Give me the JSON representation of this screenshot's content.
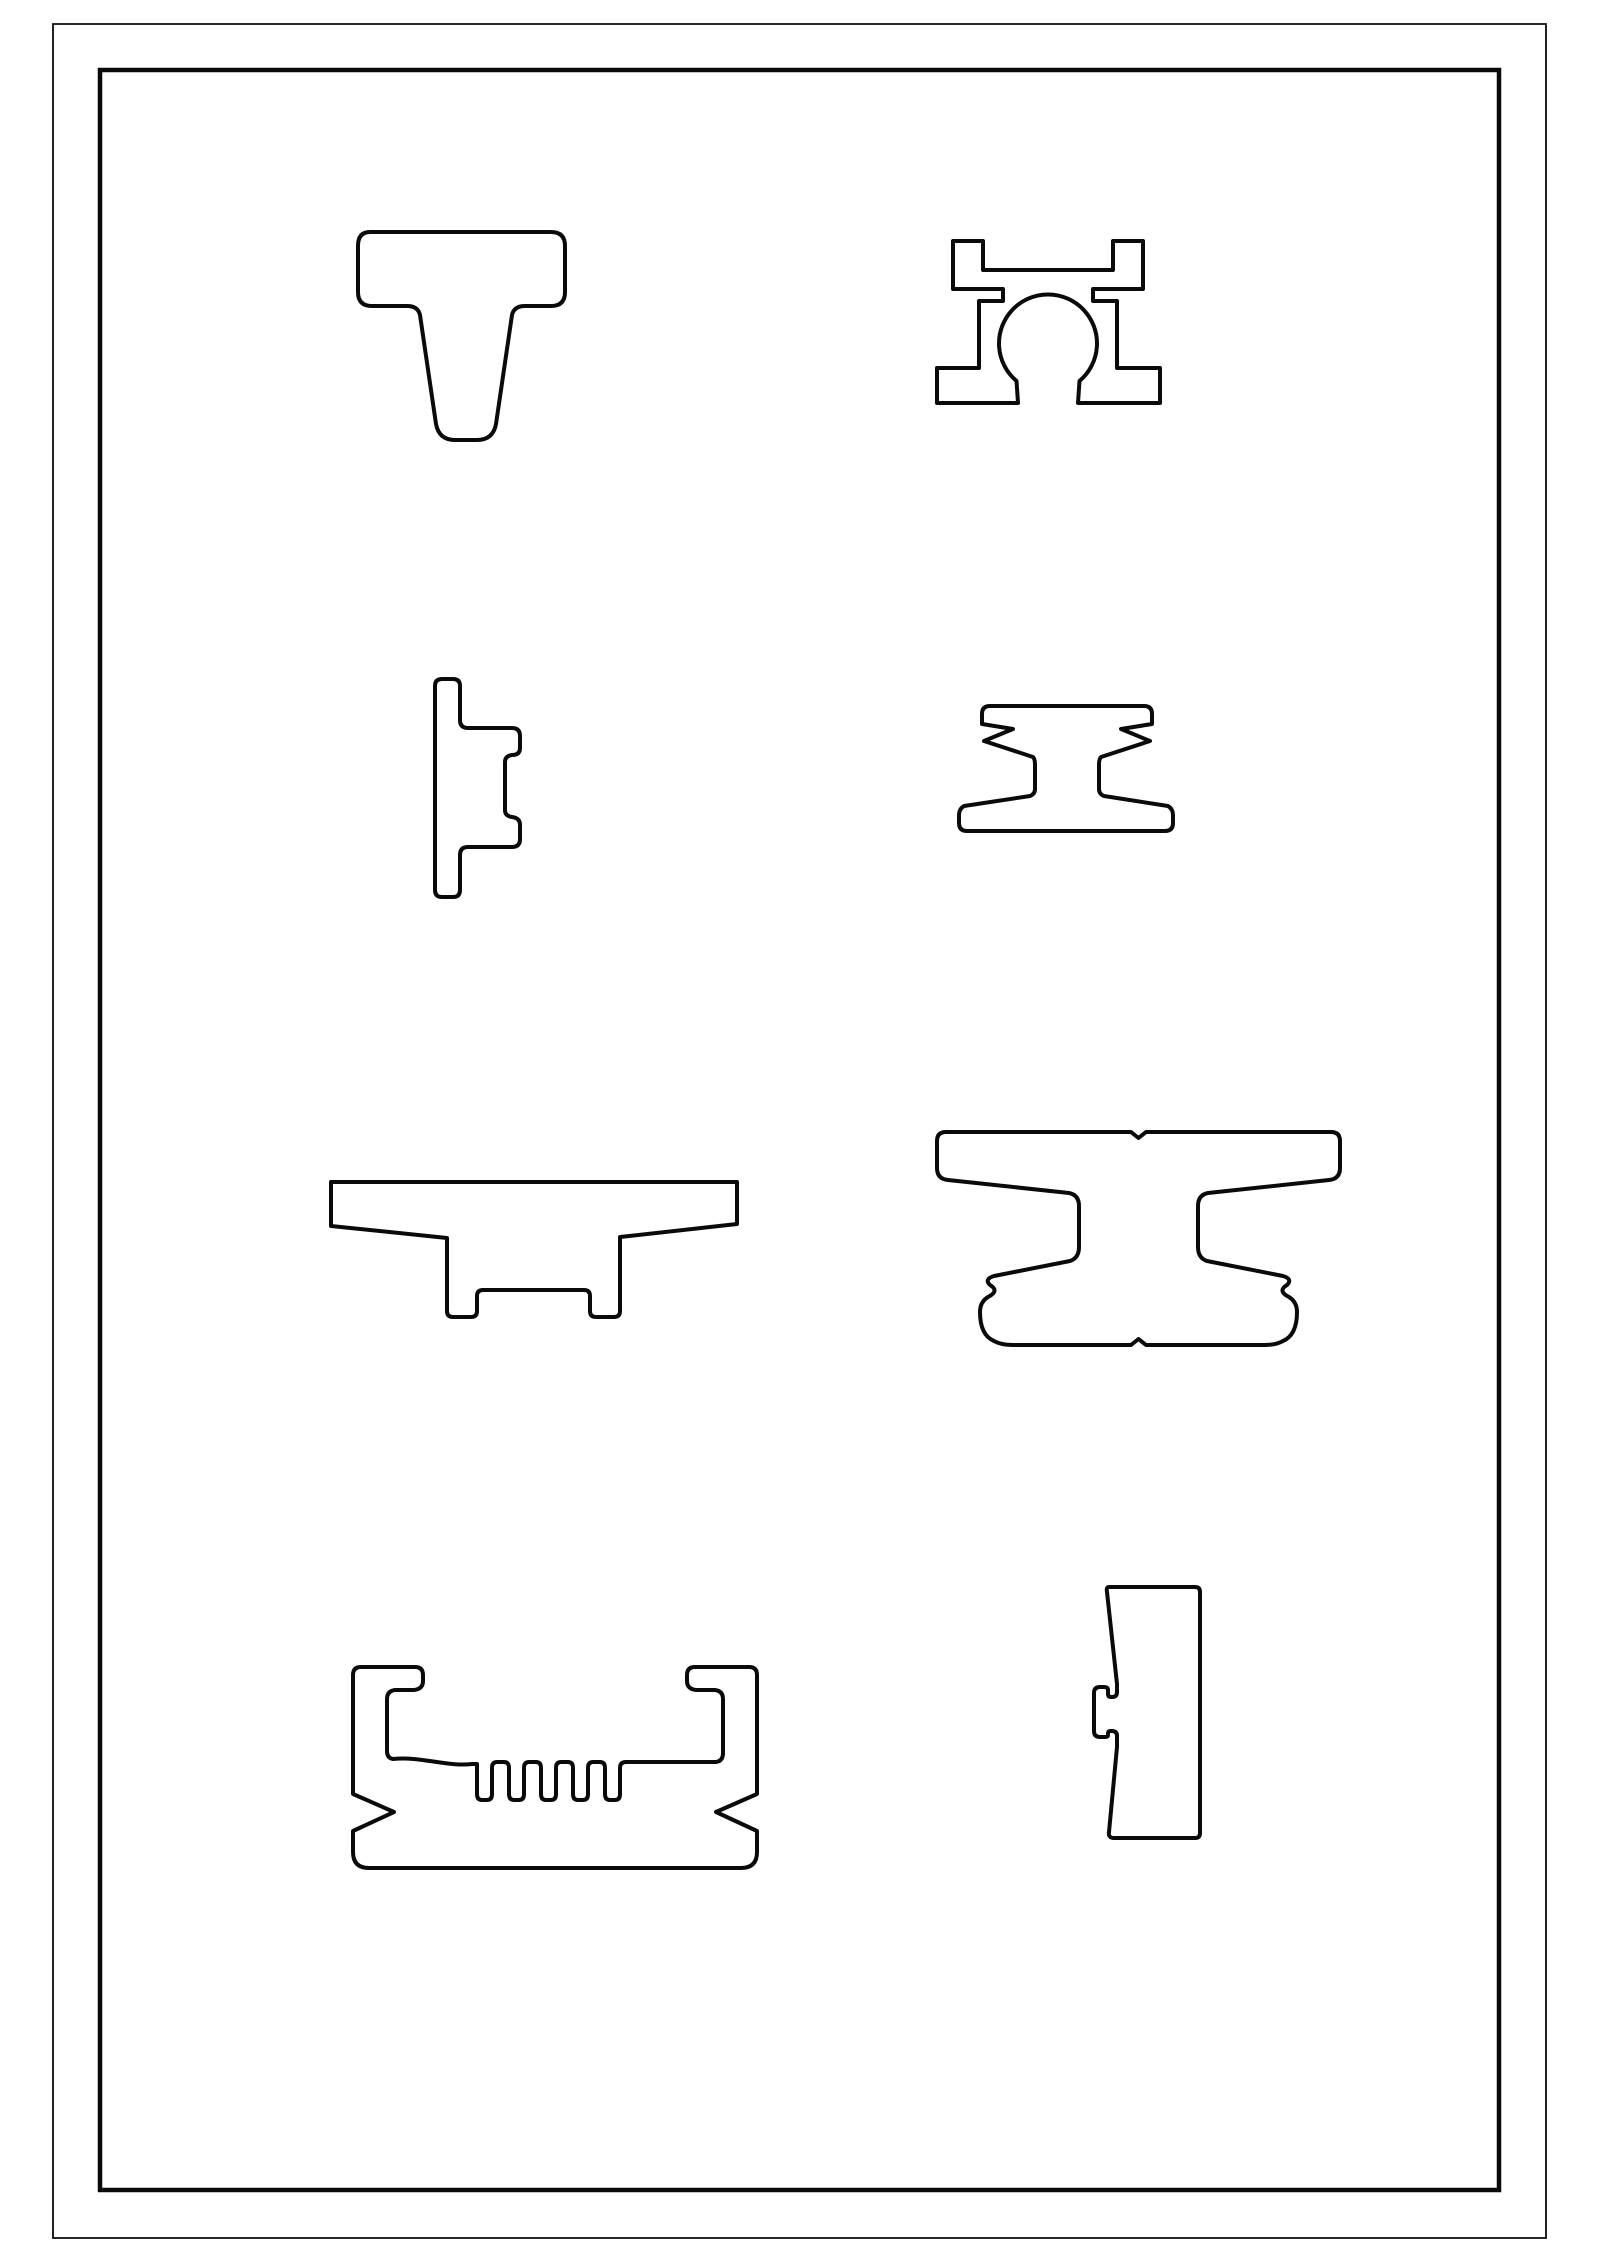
{
  "page": {
    "width": 1600,
    "height": 2263,
    "background_color": "#ffffff"
  },
  "drawing": {
    "ink_color": "#0a0a0a",
    "frames": {
      "outer": {
        "path": "M 53 24 H 1546 V 2238 H 53 Z"
      },
      "inner": {
        "path": "M 100 70 H 1499 V 2190 H 100 Z"
      }
    },
    "shapes": [
      {
        "name": "t-slot-bolt-profile",
        "path": "M 370 232 H 551 Q 565 232 565 246 V 292 Q 565 306 551 306 H 525 Q 514 306 512 315 L 496 424 Q 493 440 477 440 H 455 Q 439 440 436 424 L 420 315 Q 418 306 407 306 H 372 Q 358 306 358 292 V 246 Q 358 232 370 232 Z"
      },
      {
        "name": "clamp-block-bore-profile",
        "path": "M 953 241 H 983 V 270 H 1113 V 241 H 1143 V 289 H 1093 V 301 H 1117 V 368 H 1160 V 403 H 1078 L 1079.5 381 A 49 49 0 1 0 1016.5 381 L 1018 403 H 937 V 368 H 979 V 301 H 1003 V 289 H 953 Z"
      },
      {
        "name": "side-bracket-key-profile",
        "path": "M 442 679 H 453 Q 460 679 460 686 V 720 Q 460 728 468 728 H 512 Q 520 728 520 736 V 748 Q 520 755 512 755 Q 505 756 505 762 V 810 Q 505 816 512 817 Q 520 818 520 825 V 839 Q 520 847 512 847 H 468 Q 460 847 460 855 V 890 Q 460 897 453 897 H 442 Q 435 897 435 890 V 686 Q 435 679 442 679 Z"
      },
      {
        "name": "barbed-rail-profile",
        "path": "M 990 706 H 1144 Q 1152 706 1152 714 V 724 L 1121 729 L 1150 741 L 1101 757 Q 1099 759 1099 765 V 789 Q 1099 794 1104 796 L 1168 806 Q 1173 809 1173 815 V 823 Q 1173 831 1165 831 H 967 Q 959 831 959 823 V 815 Q 959 809 964 806 L 1030 796 Q 1035 794 1035 789 V 765 Q 1035 759 1033 757 L 984 741 L 1013 729 L 982 724 V 714 Q 982 706 990 706 Z"
      },
      {
        "name": "anvil-plate-profile",
        "path": "M 331 1182 H 737 V 1224 L 620 1237 V 1311 Q 620 1317 614 1317 H 596 Q 590 1317 590 1311 V 1296 Q 590 1290 584 1290 H 483 Q 477 1290 477 1296 V 1311 Q 477 1317 471 1317 H 453 Q 447 1317 447 1311 V 1238 L 331 1226 Z"
      },
      {
        "name": "curved-i-beam-profile",
        "path": "M 946 1132 H 1131 L 1138.5 1138 L 1146 1132 H 1331 Q 1340 1132 1340 1141 V 1168 Q 1340 1179 1329 1180 L 1208 1193 Q 1198 1195 1198 1206 V 1247 Q 1198 1258 1207 1261 L 1283 1276 Q 1293 1279 1287 1285 Q 1277 1291 1289 1297 Q 1297 1302 1297 1312 Q 1297 1335 1283 1341 Q 1276 1345 1264 1345 H 1146 L 1138.5 1339 L 1131 1345 H 1013 Q 1001 1345 994 1341 Q 980 1335 980 1312 Q 980 1302 988 1297 Q 1000 1291 990 1285 Q 984 1279 994 1276 L 1070 1261 Q 1079 1258 1079 1247 V 1206 Q 1079 1195 1069 1193 L 948 1180 Q 937 1179 937 1168 V 1141 Q 937 1132 946 1132 Z"
      },
      {
        "name": "finned-channel-profile",
        "path": "M 361 1667 H 415 Q 423 1667 423 1675 V 1681 Q 423 1689 414 1690 H 395 Q 387 1691 387 1699 V 1751 Q 387 1758 393 1759 C 420 1756 448 1767 472 1764 L 477 1764 V 1794 Q 477 1800 482 1800 H 487 Q 492 1800 492 1794 V 1768 Q 492 1762 497 1762 H 504 Q 509 1762 509 1768 V 1794 Q 509 1800 514 1800 H 519 Q 524 1800 524 1794 V 1768 Q 524 1762 529 1762 H 536 Q 541 1762 541 1768 V 1794 Q 541 1800 546 1800 H 551 Q 556 1800 556 1794 V 1768 Q 556 1762 561 1762 H 568 Q 573 1762 573 1768 V 1794 Q 573 1800 578 1800 H 583 Q 588 1800 588 1794 V 1768 Q 588 1762 593 1762 H 600 Q 605 1762 605 1768 V 1794 Q 605 1800 610 1800 H 615 Q 620 1800 620 1794 V 1768 Q 620 1762 626 1762 H 716 Q 723 1761 723 1753 V 1699 Q 723 1691 715 1690 H 696 Q 687 1689 687 1681 V 1675 Q 687 1667 695 1667 H 749 Q 757 1667 757 1675 V 1794 L 716 1812 L 757 1831 V 1852 Q 757 1868 741 1868 H 369 Q 353 1868 353 1852 V 1831 L 394 1812 L 353 1794 V 1675 Q 353 1667 361 1667 Z"
      },
      {
        "name": "wedge-bar-tab-profile",
        "path": "M 1109 1587 H 1195 Q 1200 1587 1200 1592 V 1833 Q 1200 1838 1195 1838 H 1114 Q 1108 1838 1109 1832 L 1117 1747 V 1736 Q 1117 1731 1112 1731 H 1110 Q 1108 1731 1108 1734 V 1735 Q 1108 1737 1105 1737 H 1100 Q 1094 1737 1094 1731 V 1693 Q 1094 1687 1100 1687 H 1104 Q 1108 1687 1108 1690 V 1694 Q 1108 1697 1111 1697 H 1112 Q 1117 1697 1117 1692 V 1684 L 1107 1592 Q 1106 1587 1109 1587 Z"
      }
    ]
  }
}
